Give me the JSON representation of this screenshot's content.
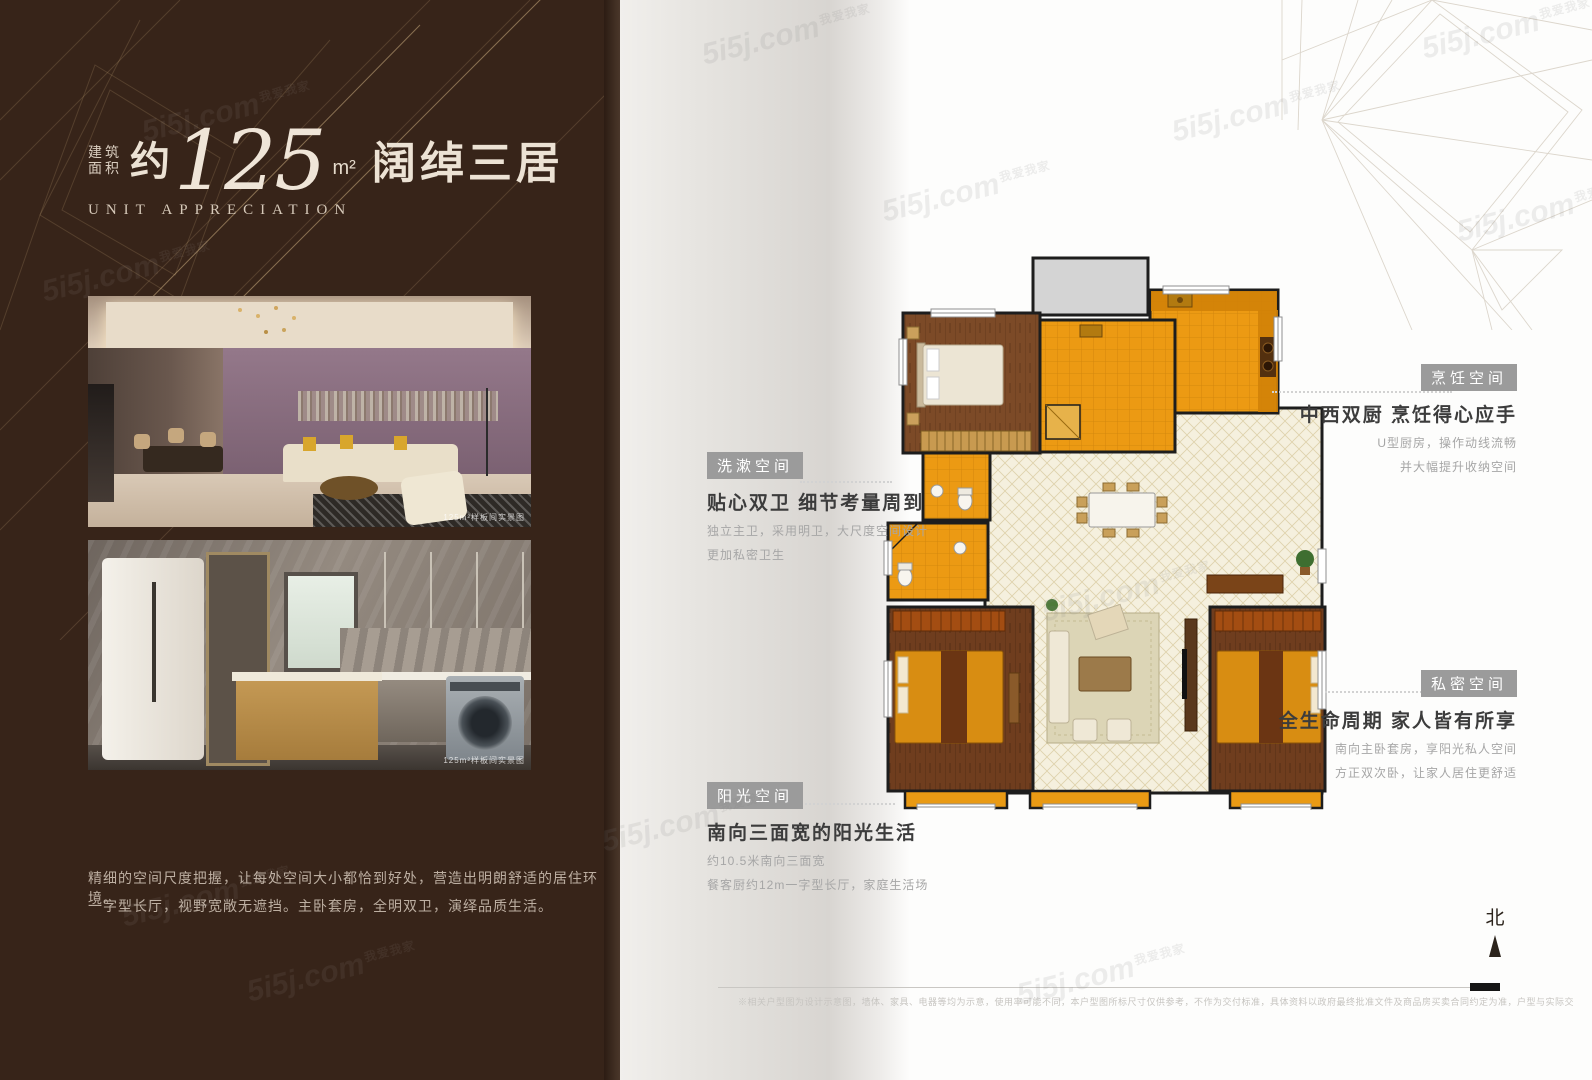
{
  "watermark": {
    "site": "5i5j.com",
    "tag": "我爱我家"
  },
  "left_panel": {
    "area_label_line1": "建筑",
    "area_label_line2": "面积",
    "approx": "约",
    "area_value": "125",
    "area_unit": "m²",
    "title_cn": "阔绰三居",
    "subtitle_en": "UNIT APPRECIATION",
    "photo_caption": "125m²样板间实景图",
    "description_line1": "精细的空间尺度把握，让每处空间大小都恰到好处，营造出明朗舒适的居住环境。",
    "description_line2": "一字型长厅，视野宽敞无遮挡。主卧套房，全明双卫，演绎品质生活。"
  },
  "annotations": [
    {
      "id": "cooking",
      "label": "烹饪空间",
      "headline": "中西双厨 烹饪得心应手",
      "lines": [
        "U型厨房，操作动线流畅",
        "并大幅提升收纳空间"
      ]
    },
    {
      "id": "washing",
      "label": "洗漱空间",
      "headline": "贴心双卫 细节考量周到",
      "lines": [
        "独立主卫，采用明卫，大尺度空间设计",
        "更加私密卫生"
      ]
    },
    {
      "id": "private",
      "label": "私密空间",
      "headline": "全生命周期 家人皆有所享",
      "lines": [
        "南向主卧套房，享阳光私人空间",
        "方正双次卧，让家人居住更舒适"
      ]
    },
    {
      "id": "sunshine",
      "label": "阳光空间",
      "headline": "南向三面宽的阳光生活",
      "lines": [
        "约10.5米南向三面宽",
        "餐客厨约12m一字型长厅，家庭生活场"
      ]
    }
  ],
  "floor_plan": {
    "north_label": "北"
  },
  "footer": {
    "disclaimer": "※相关户型图为设计示意图，墙体、家具、电器等均为示意，使用率可能不同，本户型图所标尺寸仅供参考，不作为交付标准，具体资料以政府最终批准文件及商品房买卖合同约定为准，户型与实际交房可能略有差异，具体交付内容以合同约定为准。"
  },
  "colors": {
    "panel_brown": "#372419",
    "plan_orange": "#ec9a13",
    "plan_wood": "#7c4a27",
    "plan_tile": "#f5f0de",
    "badge_gray": "#9b9b9b"
  }
}
